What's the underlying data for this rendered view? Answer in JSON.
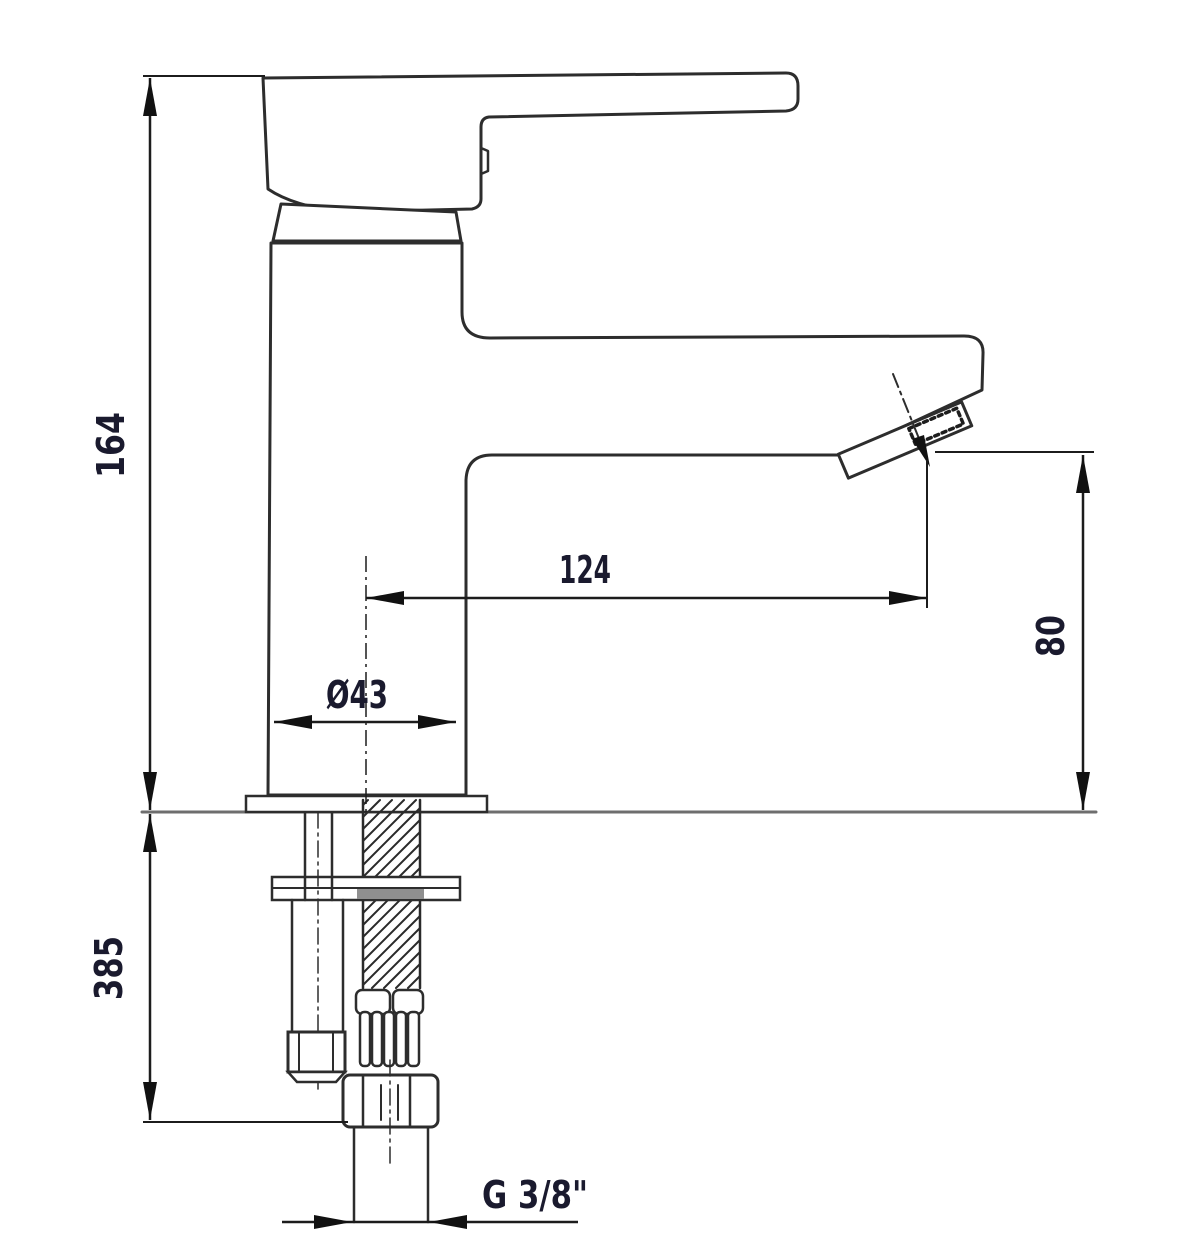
{
  "drawing": {
    "kind": "technical-dimension-drawing",
    "subject": "single-lever basin mixer faucet, side elevation with mounting hardware",
    "labels": {
      "total_height": "164",
      "spout_reach": "124",
      "outlet_height": "80",
      "body_diameter": "Ø43",
      "below_deck_length": "385",
      "thread_size": "G 3/8\""
    },
    "colors": {
      "background": "#ffffff",
      "outline": "#2d2d2d",
      "dimension_line": "#1c1c1c",
      "label_text": "#1a1a2e",
      "reference_gray": "#6e6e6e",
      "slot_gray": "#8f8f8f"
    }
  }
}
